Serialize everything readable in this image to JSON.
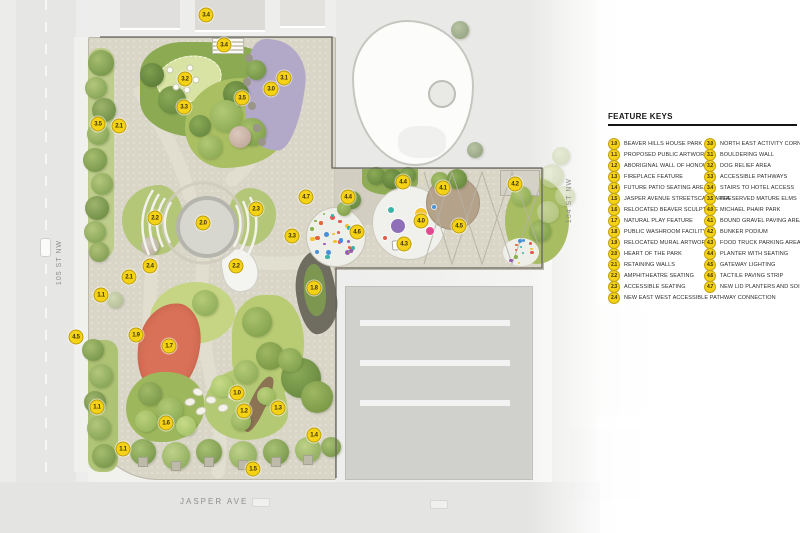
{
  "legend": {
    "title": "FEATURE KEYS",
    "columns": [
      {
        "items": [
          {
            "key": "1.0",
            "label": "BEAVER HILLS HOUSE PARK"
          },
          {
            "key": "1.1",
            "label": "PROPOSED PUBLIC ARTWORK"
          },
          {
            "key": "1.2",
            "label": "ABORIGINAL WALL OF HONOUR"
          },
          {
            "key": "1.3",
            "label": "FIREPLACE FEATURE"
          },
          {
            "key": "1.4",
            "label": "FUTURE PATIO SEATING AREA"
          },
          {
            "key": "1.5",
            "label": "JASPER AVENUE STREETSCAPE AREA"
          },
          {
            "key": "1.6",
            "label": "RELOCATED BEAVER SCULPTURE"
          },
          {
            "key": "1.7",
            "label": "NATURAL PLAY FEATURE"
          },
          {
            "key": "1.8",
            "label": "PUBLIC WASHROOM FACILITY"
          },
          {
            "key": "1.9",
            "label": "RELOCATED MURAL ARTWORK"
          },
          {
            "key": "2.0",
            "label": "HEART OF THE PARK"
          },
          {
            "key": "2.1",
            "label": "RETAINING WALLS"
          },
          {
            "key": "2.2",
            "label": "AMPHITHEATRE SEATING"
          },
          {
            "key": "2.3",
            "label": "ACCESSIBLE SEATING"
          },
          {
            "key": "2.4",
            "label": "NEW EAST WEST ACCESSIBLE PATHWAY CONNECTION"
          }
        ]
      },
      {
        "items": [
          {
            "key": "3.0",
            "label": "NORTH EAST ACTIVITY CORNER"
          },
          {
            "key": "3.1",
            "label": "BOULDERING WALL"
          },
          {
            "key": "3.2",
            "label": "DOG RELIEF AREA"
          },
          {
            "key": "3.3",
            "label": "ACCESSIBLE PATHWAYS"
          },
          {
            "key": "3.4",
            "label": "STAIRS TO HOTEL ACCESS"
          },
          {
            "key": "3.5",
            "label": "PRESERVED MATURE ELMS"
          },
          {
            "key": "4.0",
            "label": "MICHAEL PHAIR PARK"
          },
          {
            "key": "4.1",
            "label": "BOUND GRAVEL PAVING AREA"
          },
          {
            "key": "4.2",
            "label": "BUNKER PODIUM"
          },
          {
            "key": "4.3",
            "label": "FOOD TRUCK PARKING AREA"
          },
          {
            "key": "4.4",
            "label": "PLANTER WITH SEATING"
          },
          {
            "key": "4.5",
            "label": "GATEWAY LIGHTING"
          },
          {
            "key": "4.6",
            "label": "TACTILE PAVING STRIP"
          },
          {
            "key": "4.7",
            "label": "NEW LID PLANTERS AND SOIL CELLS"
          }
        ]
      }
    ]
  },
  "streets": {
    "west": "105 ST NW",
    "east": "104 ST NW",
    "south": "JASPER AVE"
  },
  "map": {
    "marker_color": "#F5D216",
    "markers": [
      {
        "key": "3.4",
        "x": 206,
        "y": 15
      },
      {
        "key": "3.4",
        "x": 224,
        "y": 45
      },
      {
        "key": "3.2",
        "x": 185,
        "y": 79
      },
      {
        "key": "3.1",
        "x": 284,
        "y": 78
      },
      {
        "key": "3.0",
        "x": 271,
        "y": 89
      },
      {
        "key": "3.5",
        "x": 242,
        "y": 98
      },
      {
        "key": "3.3",
        "x": 184,
        "y": 107
      },
      {
        "key": "3.5",
        "x": 98,
        "y": 124
      },
      {
        "key": "2.1",
        "x": 119,
        "y": 126
      },
      {
        "key": "2.2",
        "x": 155,
        "y": 218
      },
      {
        "key": "2.0",
        "x": 203,
        "y": 223
      },
      {
        "key": "2.3",
        "x": 256,
        "y": 209
      },
      {
        "key": "2.2",
        "x": 236,
        "y": 266
      },
      {
        "key": "2.4",
        "x": 150,
        "y": 266
      },
      {
        "key": "2.1",
        "x": 129,
        "y": 277
      },
      {
        "key": "1.1",
        "x": 101,
        "y": 295
      },
      {
        "key": "3.3",
        "x": 292,
        "y": 236
      },
      {
        "key": "1.8",
        "x": 314,
        "y": 288
      },
      {
        "key": "4.5",
        "x": 76,
        "y": 337
      },
      {
        "key": "1.9",
        "x": 136,
        "y": 335
      },
      {
        "key": "1.7",
        "x": 169,
        "y": 346
      },
      {
        "key": "1.1",
        "x": 97,
        "y": 407
      },
      {
        "key": "1.6",
        "x": 166,
        "y": 423
      },
      {
        "key": "1.1",
        "x": 123,
        "y": 449
      },
      {
        "key": "1.0",
        "x": 237,
        "y": 393
      },
      {
        "key": "1.2",
        "x": 244,
        "y": 411
      },
      {
        "key": "1.3",
        "x": 278,
        "y": 408
      },
      {
        "key": "1.4",
        "x": 314,
        "y": 435
      },
      {
        "key": "1.5",
        "x": 253,
        "y": 469
      },
      {
        "key": "4.7",
        "x": 306,
        "y": 197
      },
      {
        "key": "4.4",
        "x": 348,
        "y": 197
      },
      {
        "key": "4.6",
        "x": 357,
        "y": 232
      },
      {
        "key": "4.4",
        "x": 403,
        "y": 182
      },
      {
        "key": "4.0",
        "x": 421,
        "y": 221
      },
      {
        "key": "4.1",
        "x": 443,
        "y": 188
      },
      {
        "key": "4.5",
        "x": 459,
        "y": 226
      },
      {
        "key": "4.3",
        "x": 404,
        "y": 244
      },
      {
        "key": "4.2",
        "x": 515,
        "y": 184
      }
    ],
    "plaza_dots": [
      {
        "x": 398,
        "y": 226,
        "r": 7,
        "c": "#8e6fb8"
      },
      {
        "x": 421,
        "y": 214,
        "r": 6,
        "c": "#f2c230"
      },
      {
        "x": 430,
        "y": 231,
        "r": 4,
        "c": "#e24a90"
      },
      {
        "x": 391,
        "y": 210,
        "r": 3,
        "c": "#3bb3a9"
      },
      {
        "x": 409,
        "y": 243,
        "r": 2.5,
        "c": "#e2663c"
      },
      {
        "x": 434,
        "y": 207,
        "r": 2,
        "c": "#4a90d9"
      },
      {
        "x": 385,
        "y": 238,
        "r": 2,
        "c": "#e05a4e"
      }
    ],
    "confetti_palette": [
      "#e05a4e",
      "#4a90d9",
      "#f2c230",
      "#3bb3a9",
      "#e2663c",
      "#9b59b6",
      "#88b04b"
    ]
  }
}
